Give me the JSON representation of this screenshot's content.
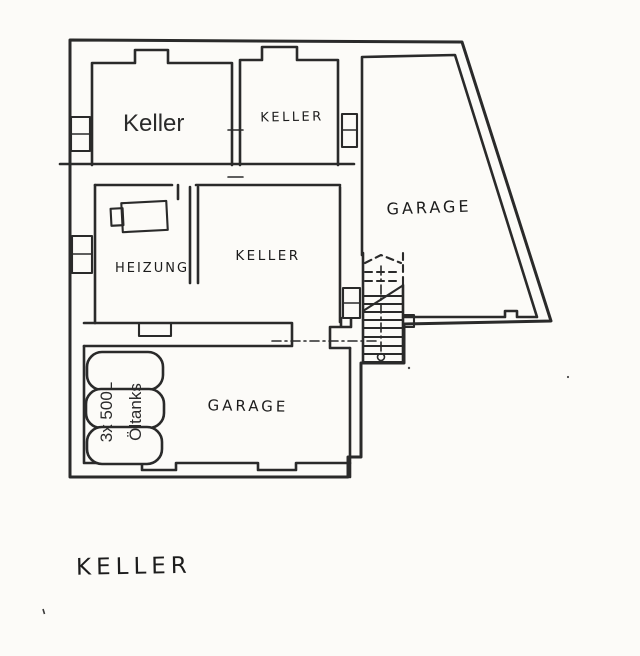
{
  "colors": {
    "paper": "#fcfbf8",
    "ink": "#2a2a2a"
  },
  "floorplan": {
    "rooms": [
      {
        "id": "keller-main",
        "label": "Keller"
      },
      {
        "id": "keller-top-right",
        "label": "KELLER"
      },
      {
        "id": "garage-upper",
        "label": "GARAGE"
      },
      {
        "id": "heizung",
        "label": "HEIZUNG"
      },
      {
        "id": "keller-middle",
        "label": "KELLER"
      },
      {
        "id": "garage-lower",
        "label": "GARAGE"
      }
    ],
    "oil_tanks": {
      "count": 3,
      "label_lines": [
        "3x 500L",
        "Öltanks"
      ]
    },
    "title": "KELLER"
  }
}
